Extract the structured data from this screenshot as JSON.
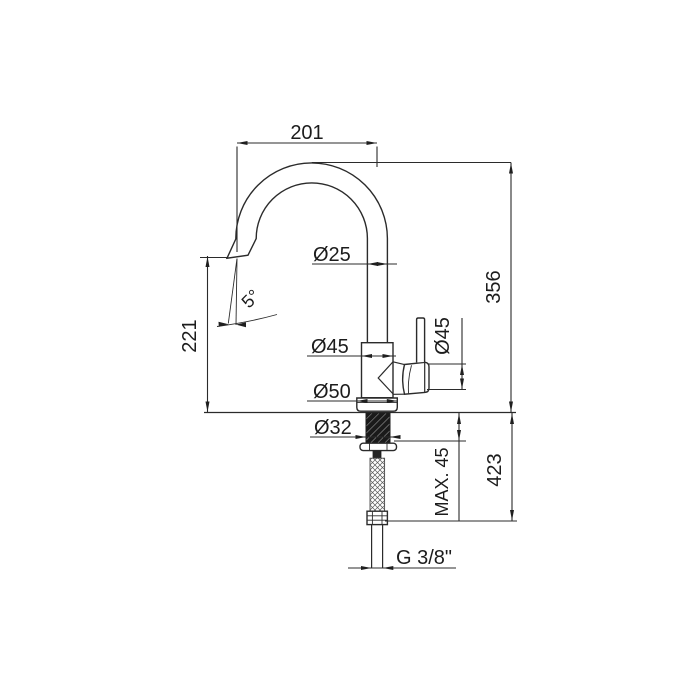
{
  "drawing": {
    "kind": "kitchen-faucet-technical-drawing",
    "dims": {
      "spout_reach": "201",
      "spout_tube_diameter": "Ø25",
      "spout_outlet_height": "221",
      "spout_outlet_angle": "5°",
      "height_above_deck": "356",
      "body_diameter": "Ø45",
      "handle_diameter": "Ø45",
      "base_diameter": "Ø50",
      "shank_diameter": "Ø32",
      "max_deck_thickness": "MAX. 45",
      "below_deck_length": "423",
      "supply_thread": "G 3/8\""
    }
  }
}
